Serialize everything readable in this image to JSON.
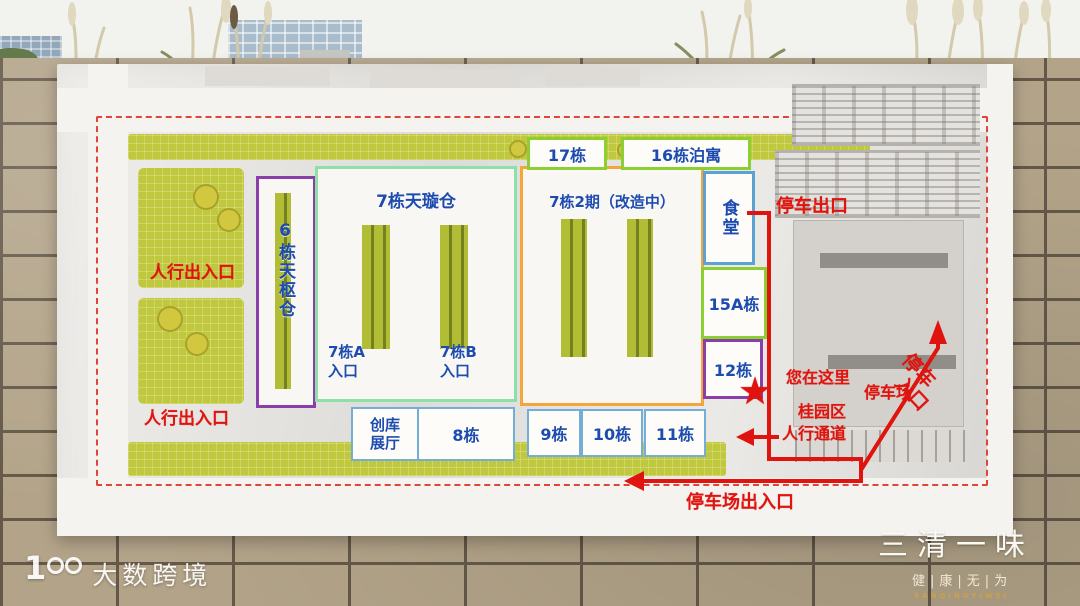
{
  "scene": {
    "description": "Photo of an industrial-park site map sign on a beige brick wall",
    "sky_color": "#f2f2ef",
    "wall_brick_color": "#b3a489",
    "accent_red": "#df140e",
    "label_blue": "#1d4cae",
    "lawn_green": "#c0c83e"
  },
  "map": {
    "top_row": {
      "b17": "17栋",
      "b16": "16栋泊寓"
    },
    "buildings": {
      "b6": "6栋天枢仓",
      "b7_title": "7栋天璇仓",
      "b7a_l1": "7栋A",
      "b7a_l2": "入口",
      "b7b_l1": "7栋B",
      "b7b_l2": "入口",
      "b7p2_title": "7栋2期（改造中）",
      "canteen": "食堂",
      "b15a": "15A栋",
      "b12": "12栋",
      "chuangku_l1": "创库",
      "chuangku_l2": "展厅",
      "b8": "8栋",
      "b9": "9栋",
      "b10": "10栋",
      "b11": "11栋"
    },
    "red_annotations": {
      "parking_exit": "停车出口",
      "ped_gate_top": "人行出入口",
      "ped_gate_bottom": "人行出入口",
      "you_are_here": "您在这里",
      "star": "★",
      "area_l1": "桂园区",
      "area_l2": "人行通道",
      "parking_lot": "停车场",
      "parking_entrance_l1": "停车",
      "parking_entrance_l2": "入口",
      "parking_gate": "停车场出入口"
    }
  },
  "watermarks": {
    "left": {
      "logo_digit": "1",
      "text": "大数跨境"
    },
    "right": {
      "title": "三清一味",
      "tagline": "健|康|无|为",
      "latin": "SANQINGYIWEI"
    }
  }
}
